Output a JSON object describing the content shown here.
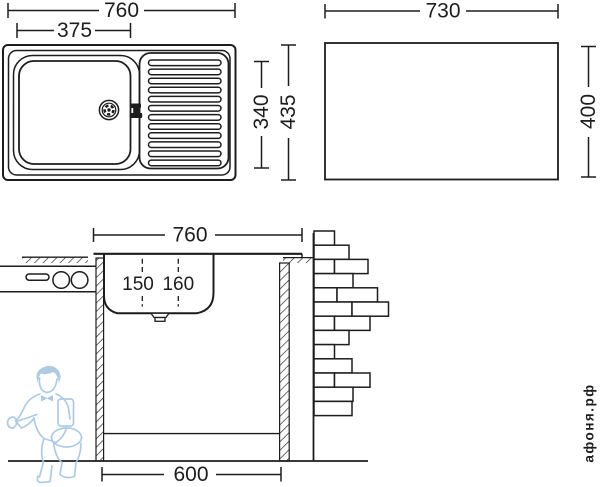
{
  "top_view": {
    "label_total_width": "760",
    "label_bowl_width": "375",
    "label_total_depth": "435",
    "label_bowl_depth": "340"
  },
  "cutout_view": {
    "label_width": "730",
    "label_height": "400"
  },
  "section_view": {
    "label_width": "760",
    "label_depth_left": "150",
    "label_depth_right": "160",
    "label_cabinet_width": "600"
  },
  "watermark": {
    "text": "афоня.рф"
  },
  "colors": {
    "line": "#1d1d1d",
    "logo_blue": "#a9c7e2",
    "watermark_gray": "#c6c6c6"
  }
}
